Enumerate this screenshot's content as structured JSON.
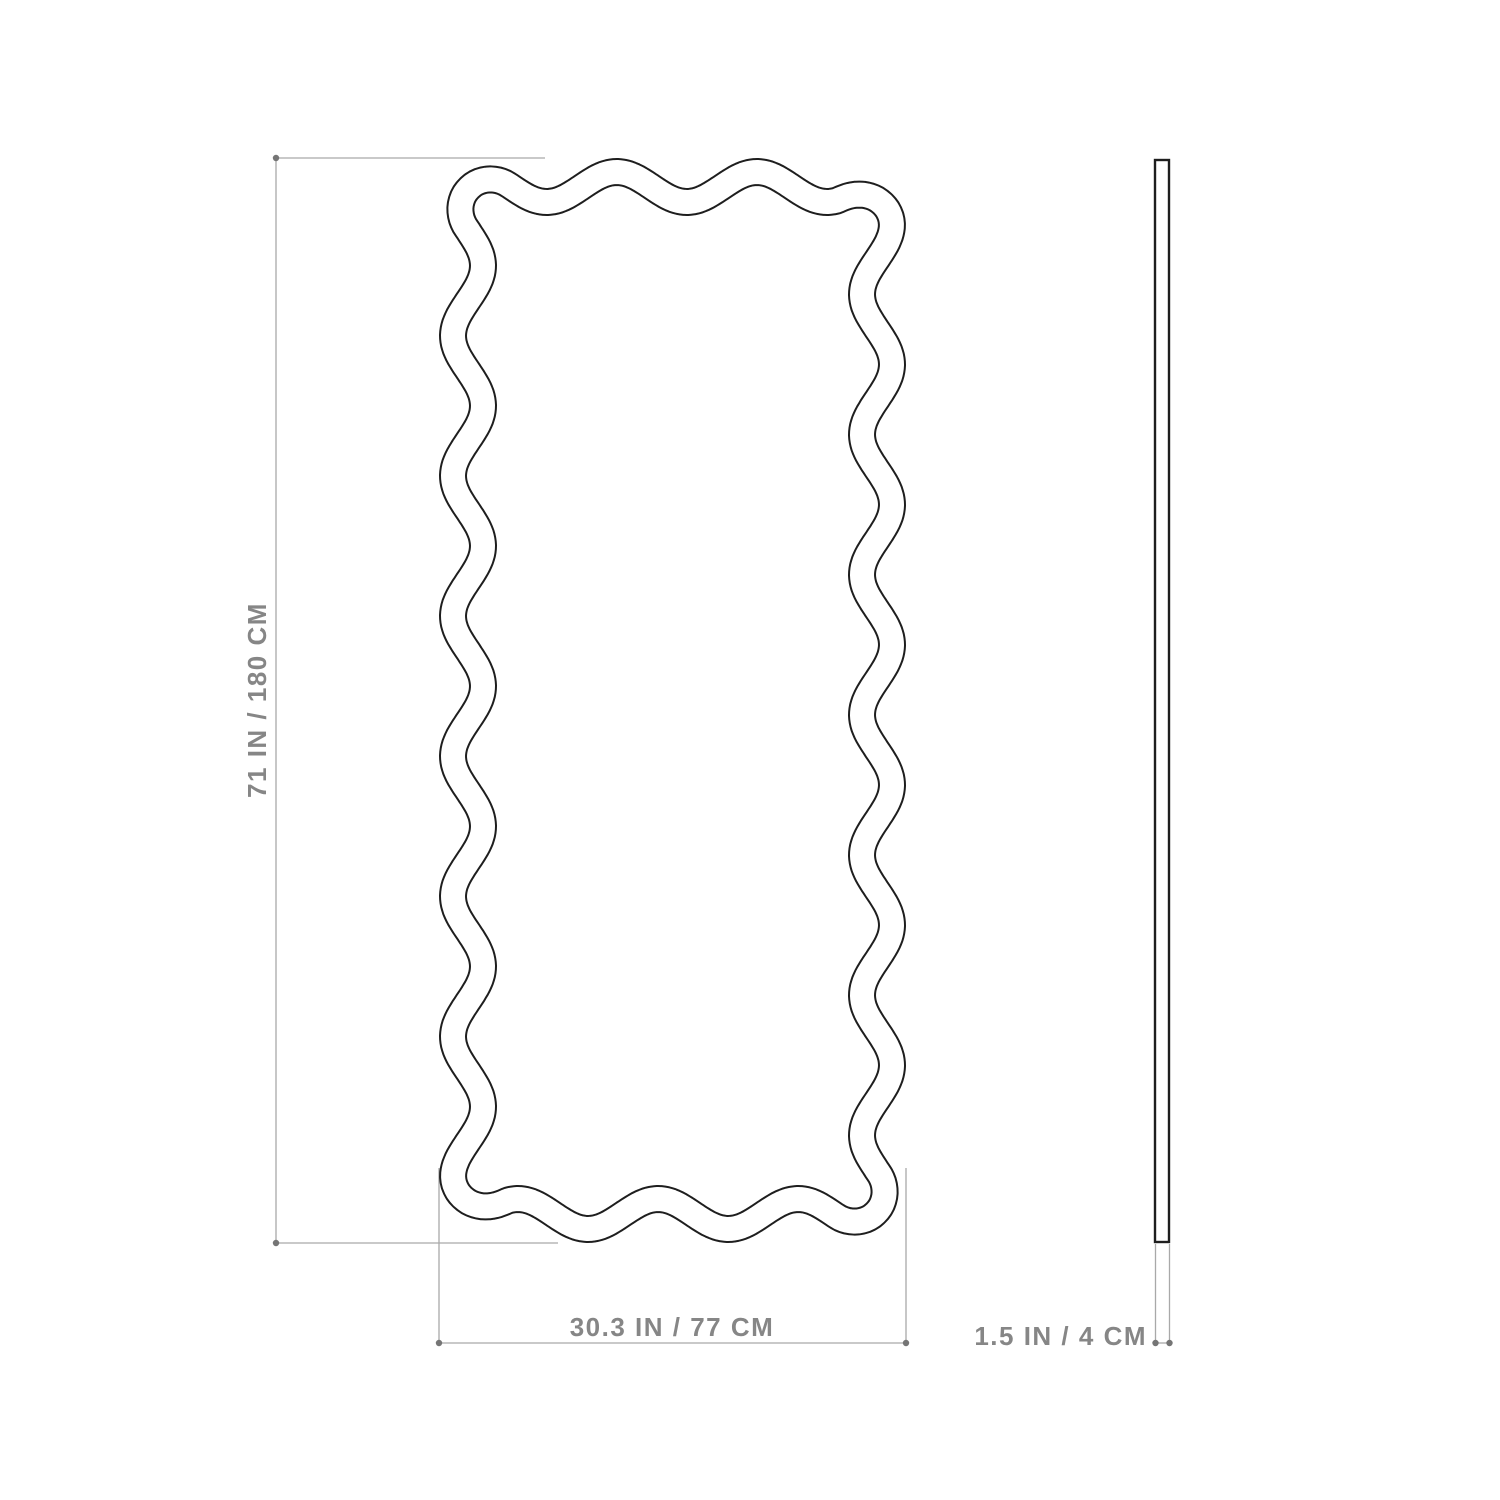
{
  "front_view": {
    "height_label": "71 IN / 180 CM",
    "width_label": "30.3 IN / 77 CM"
  },
  "side_view": {
    "depth_label": "1.5 IN / 4 CM"
  },
  "colors": {
    "outline": "#1e1e1e",
    "dimension_line": "#a9a9a9",
    "label_text": "#868686",
    "endpoint_dot": "#757575",
    "background": "#ffffff"
  }
}
